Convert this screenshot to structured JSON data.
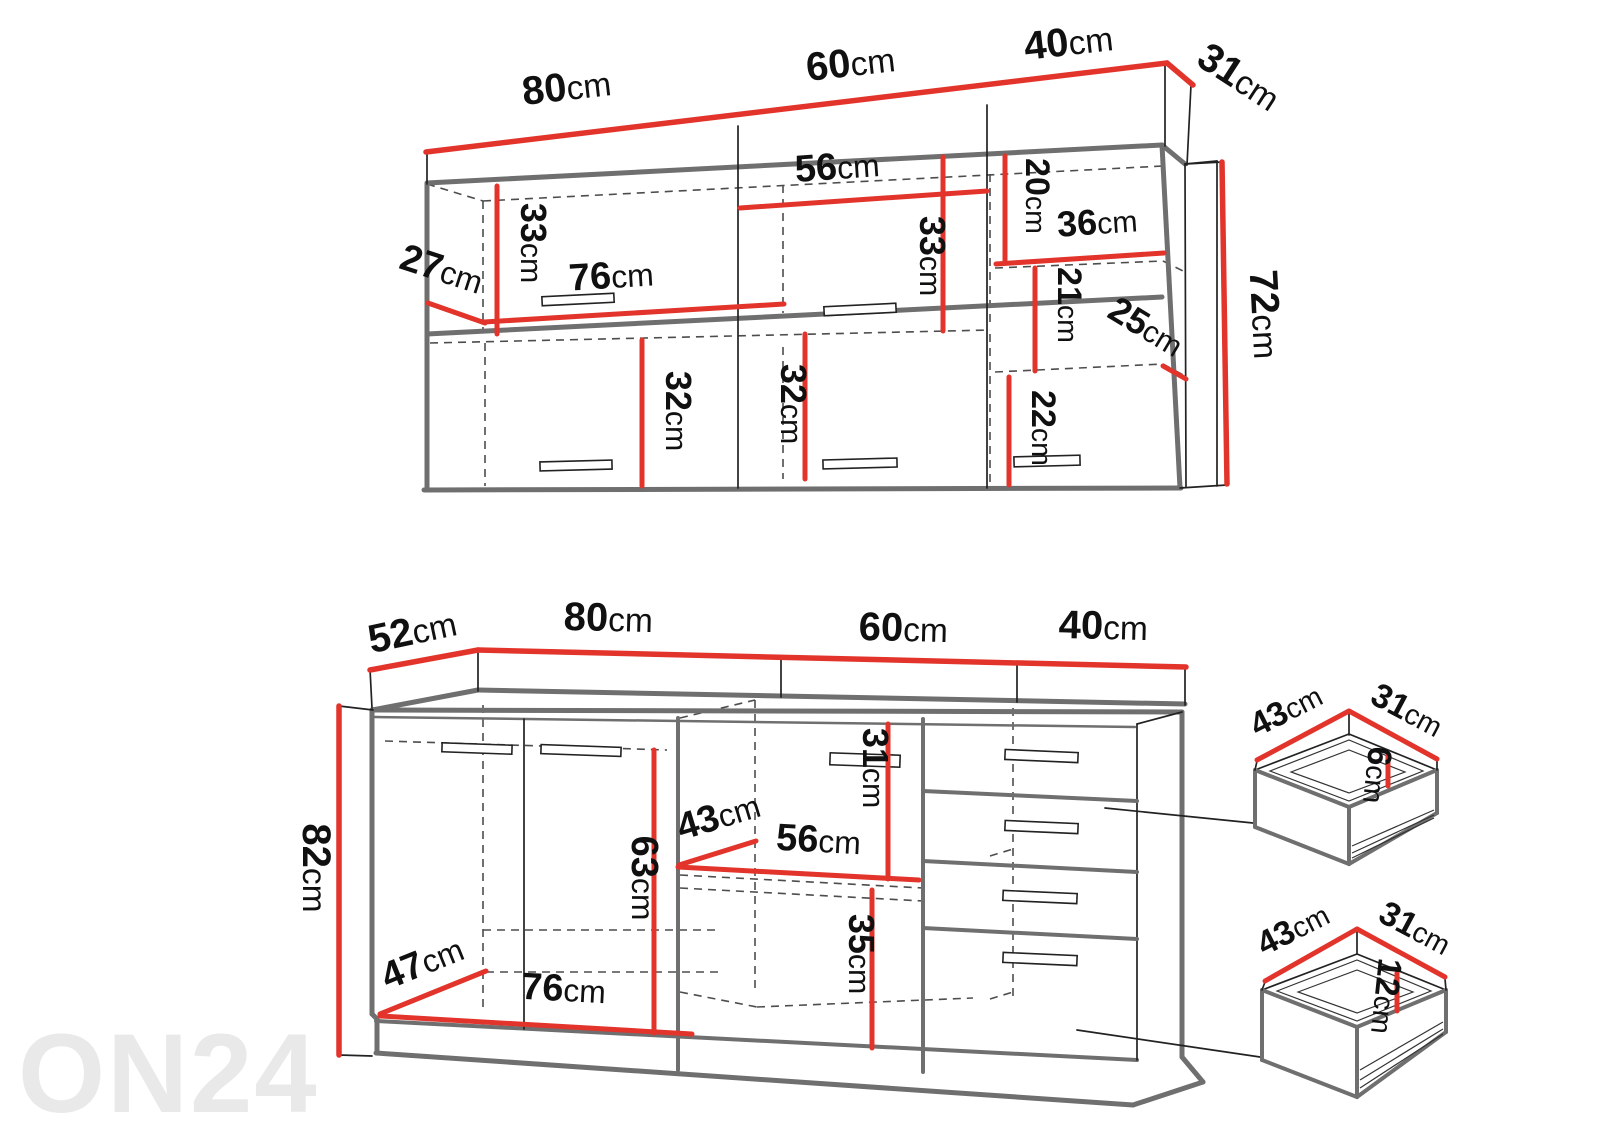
{
  "watermark": {
    "text": "ON24"
  },
  "colors": {
    "dimension_red": "#e2342b",
    "outline_gray": "#6f6f6f",
    "label_black": "#101010",
    "watermark_gray": "#e9e9e9"
  },
  "wall_cabinet": {
    "width_left": {
      "num": "80",
      "unit": "cm"
    },
    "width_middle": {
      "num": "60",
      "unit": "cm"
    },
    "width_right": {
      "num": "40",
      "unit": "cm"
    },
    "depth": {
      "num": "31",
      "unit": "cm"
    },
    "height": {
      "num": "72",
      "unit": "cm"
    },
    "door_depth": {
      "num": "27",
      "unit": "cm"
    },
    "upper_left_height": {
      "num": "33",
      "unit": "cm"
    },
    "shelf_width": {
      "num": "76",
      "unit": "cm"
    },
    "upper_middle_width": {
      "num": "56",
      "unit": "cm"
    },
    "upper_middle_height": {
      "num": "33",
      "unit": "cm"
    },
    "lower_left_height": {
      "num": "32",
      "unit": "cm"
    },
    "lower_middle_height": {
      "num": "32",
      "unit": "cm"
    },
    "right_top_height": {
      "num": "20",
      "unit": "cm"
    },
    "right_shelf_width": {
      "num": "36",
      "unit": "cm"
    },
    "right_middle_height": {
      "num": "21",
      "unit": "cm"
    },
    "right_shelf_depth": {
      "num": "25",
      "unit": "cm"
    },
    "right_bottom_height": {
      "num": "22",
      "unit": "cm"
    }
  },
  "base_cabinet": {
    "depth": {
      "num": "52",
      "unit": "cm"
    },
    "width_left": {
      "num": "80",
      "unit": "cm"
    },
    "width_middle": {
      "num": "60",
      "unit": "cm"
    },
    "width_right": {
      "num": "40",
      "unit": "cm"
    },
    "height": {
      "num": "82",
      "unit": "cm"
    },
    "floor_depth": {
      "num": "47",
      "unit": "cm"
    },
    "floor_width": {
      "num": "76",
      "unit": "cm"
    },
    "door_height": {
      "num": "63",
      "unit": "cm"
    },
    "shelf_depth": {
      "num": "43",
      "unit": "cm"
    },
    "shelf_width": {
      "num": "56",
      "unit": "cm"
    },
    "upper_compartment_height": {
      "num": "31",
      "unit": "cm"
    },
    "lower_compartment_height": {
      "num": "35",
      "unit": "cm"
    }
  },
  "drawer_small": {
    "width": {
      "num": "43",
      "unit": "cm"
    },
    "depth": {
      "num": "31",
      "unit": "cm"
    },
    "height": {
      "num": "6",
      "unit": "cm"
    }
  },
  "drawer_large": {
    "width": {
      "num": "43",
      "unit": "cm"
    },
    "depth": {
      "num": "31",
      "unit": "cm"
    },
    "height": {
      "num": "12",
      "unit": "cm"
    }
  }
}
